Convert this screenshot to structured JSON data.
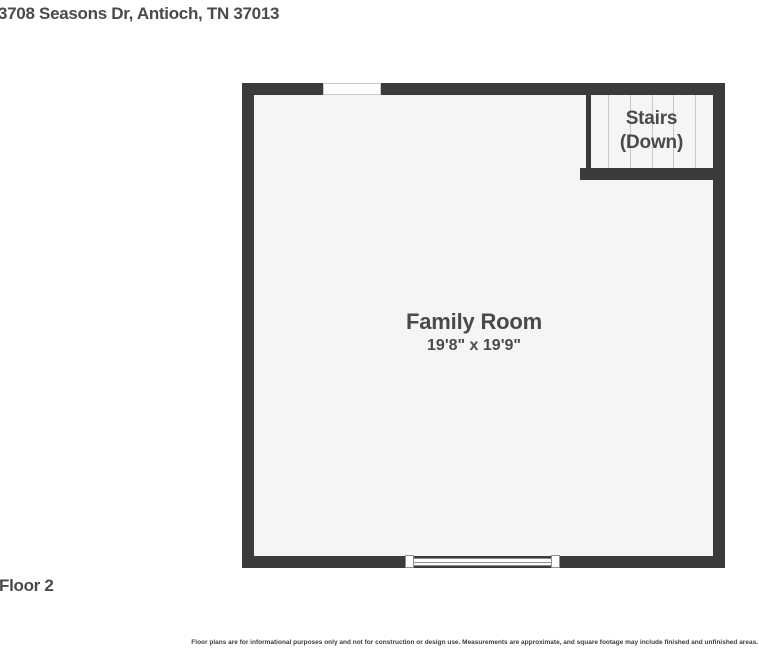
{
  "page": {
    "title": "3708 Seasons Dr, Antioch, TN 37013",
    "floor_label": "Floor 2",
    "disclaimer": "Floor plans are for informational purposes only and not for construction or design use. Measurements are approximate, and square footage may include finished and unfinished areas."
  },
  "floor_plan": {
    "room": {
      "name": "Family Room",
      "dimensions": "19'8\" x 19'9\""
    },
    "stairs": {
      "label_line1": "Stairs",
      "label_line2": "(Down)"
    },
    "features": [
      "wall-opening-top",
      "window-bottom",
      "stairs-down-top-right"
    ],
    "colors": {
      "wall": "#3b3b3b",
      "floor": "#f5f5f4",
      "label_text": "#4a4a4a",
      "stair_tread_line": "#c6c6c6",
      "window_frame": "#8f8f8f"
    }
  }
}
